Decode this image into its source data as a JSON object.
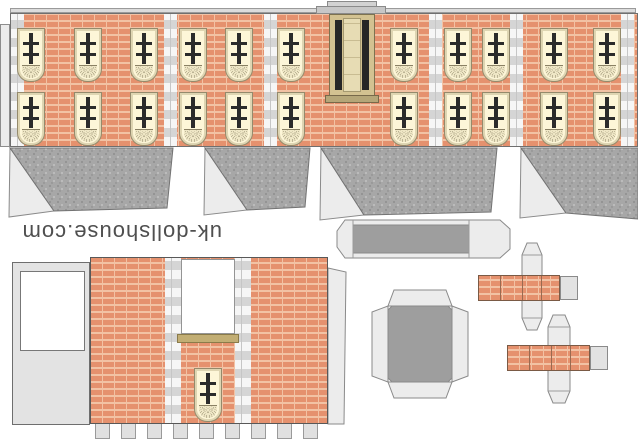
{
  "brand": {
    "text": "uk-dollshouse.com"
  },
  "colors": {
    "brick": "#e5916e",
    "mortar": "#f2c2a4",
    "quoin_light": "#f6f6f6",
    "quoin_dark": "#d5d5d5",
    "roof_base": "#a7a7a7",
    "roof_dot_dark": "#878787",
    "roof_dot_light": "#c9c9c9",
    "tab_gray": "#ececec",
    "panel_gray": "#e3e3e3",
    "box_dark": "#9e9e9e",
    "frame_cream": "#ded5b2",
    "glass": "#fdf6d8",
    "pane_dark": "#2b2b2b",
    "fan_line": "#8a8164",
    "door_tan": "#d3c291",
    "door_leaf": "#e7dcb4",
    "door_dark": "#262626",
    "sill_tan": "#c2ae74",
    "brand_text": "#4f4f4f"
  },
  "facade": {
    "window_rows_y": [
      15,
      79
    ],
    "window_centers_x": [
      30,
      87,
      143,
      192,
      238,
      290,
      403,
      457,
      495,
      553,
      606
    ],
    "quoin_x": [
      10,
      163,
      263,
      428,
      509,
      620
    ]
  },
  "rear_wall": {
    "window": {
      "x": 104,
      "y": 111
    },
    "tab_count": 9
  }
}
